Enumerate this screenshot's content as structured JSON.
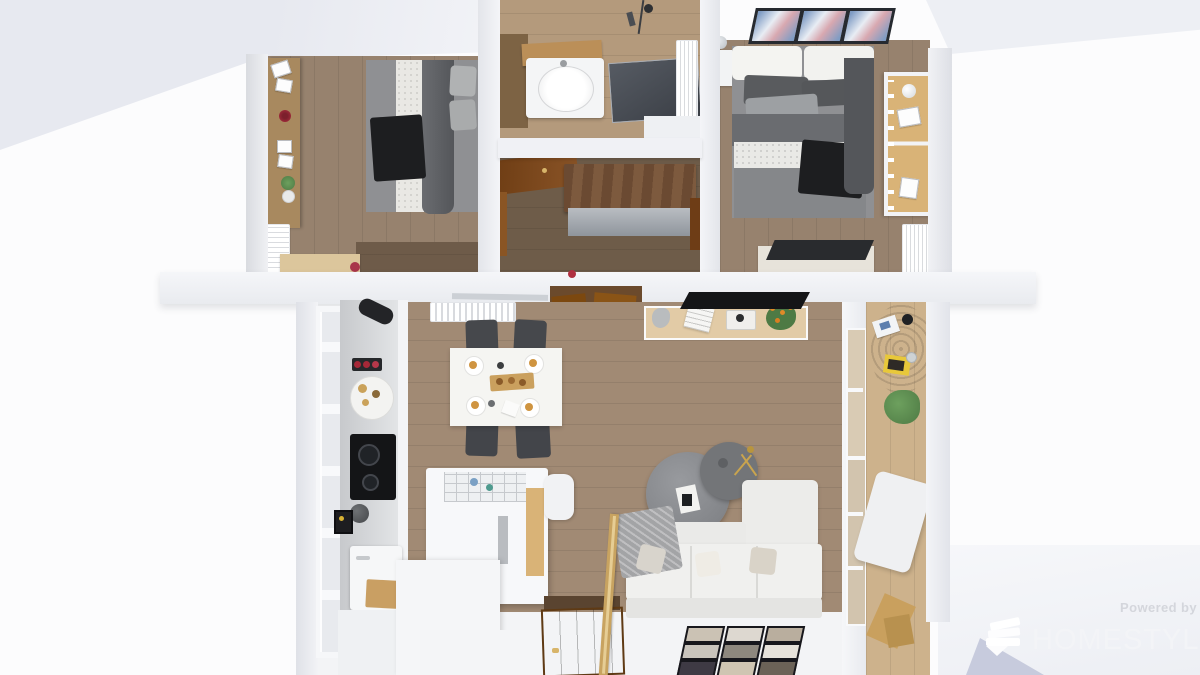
{
  "watermark": {
    "powered_by": "Powered by",
    "brand": "HOMESTYLER",
    "logo": "homestyler-fan-logo"
  },
  "palette": {
    "wood-bedroom": "#97826e",
    "wood-bedroom-dark": "#6e5b49",
    "wood-bath": "#b49a7c",
    "wood-hall": "#6e5c49",
    "wood-living": "#a18a74",
    "wood-balcony": "#cdb28c",
    "wall-white": "#f1f2f6",
    "counter-gray": "#d6d8da",
    "island-white": "#f7f8fa",
    "sofa-white": "#f0f0ee",
    "bed-gray": "#8f9093",
    "fabric-dark": "#595b5e",
    "fabric-black": "#1d1e20",
    "sideboard-tan": "#e2cba6",
    "wood-accent": "#d9b377",
    "door-brown": "#8a5427",
    "rail-wood": "#c8a360",
    "tv-black": "#141517",
    "glass-shower": "#3a3e45",
    "art-blue": "#7f9cc4",
    "art-pink": "#d8a8b0",
    "plant-green": "#4e7a44",
    "flower-red": "#b03040",
    "flower-orange": "#e08a28",
    "food-tan": "#cf9440",
    "rug-jute": "#8a6f4e",
    "magazine-yellow": "#e8c83a",
    "watermark-gray": "#d4d6dc",
    "watermark-white": "#f3f4f7"
  },
  "scene": {
    "type": "3d-floorplan-top-view",
    "rooms": [
      {
        "name": "bedroom-left",
        "furniture": [
          "double bed with gray bedding and black throw",
          "wall shelf with picture frames, red flower and plant",
          "wall tv",
          "radiator",
          "wood desk"
        ]
      },
      {
        "name": "bathroom",
        "furniture": [
          "wood vanity counter",
          "white sink unit",
          "glass shower panel",
          "hanging shower set",
          "towel radiator"
        ]
      },
      {
        "name": "hallway-closet",
        "furniture": [
          "open wood door",
          "wicker-top dresser",
          "wood door edge"
        ]
      },
      {
        "name": "bedroom-right",
        "furniture": [
          "three abstract wall artworks",
          "double bed with white headboard cushions",
          "nightstand with decor ball",
          "wardrobe with wood front",
          "radiator",
          "desk with dark top"
        ]
      },
      {
        "name": "kitchen-dining",
        "furniture": [
          "tall paned windows",
          "kitchen counter with cooktop, platter and sink",
          "dining table set for four",
          "four dark chairs",
          "kitchen island with dish rack and stool",
          "radiator",
          "black wall lamp"
        ]
      },
      {
        "name": "living-room",
        "furniture": [
          "sideboard with decor and orange plant",
          "black tv",
          "round nesting coffee tables",
          "gold floor lamp",
          "white corner sofa with pillows and knit throw",
          "gallery of nine framed photos",
          "wood stair railing",
          "wood entry door"
        ]
      },
      {
        "name": "balcony",
        "furniture": [
          "round jute rug with magazines",
          "potted plant",
          "white lounge chair",
          "wood planks"
        ]
      }
    ]
  }
}
